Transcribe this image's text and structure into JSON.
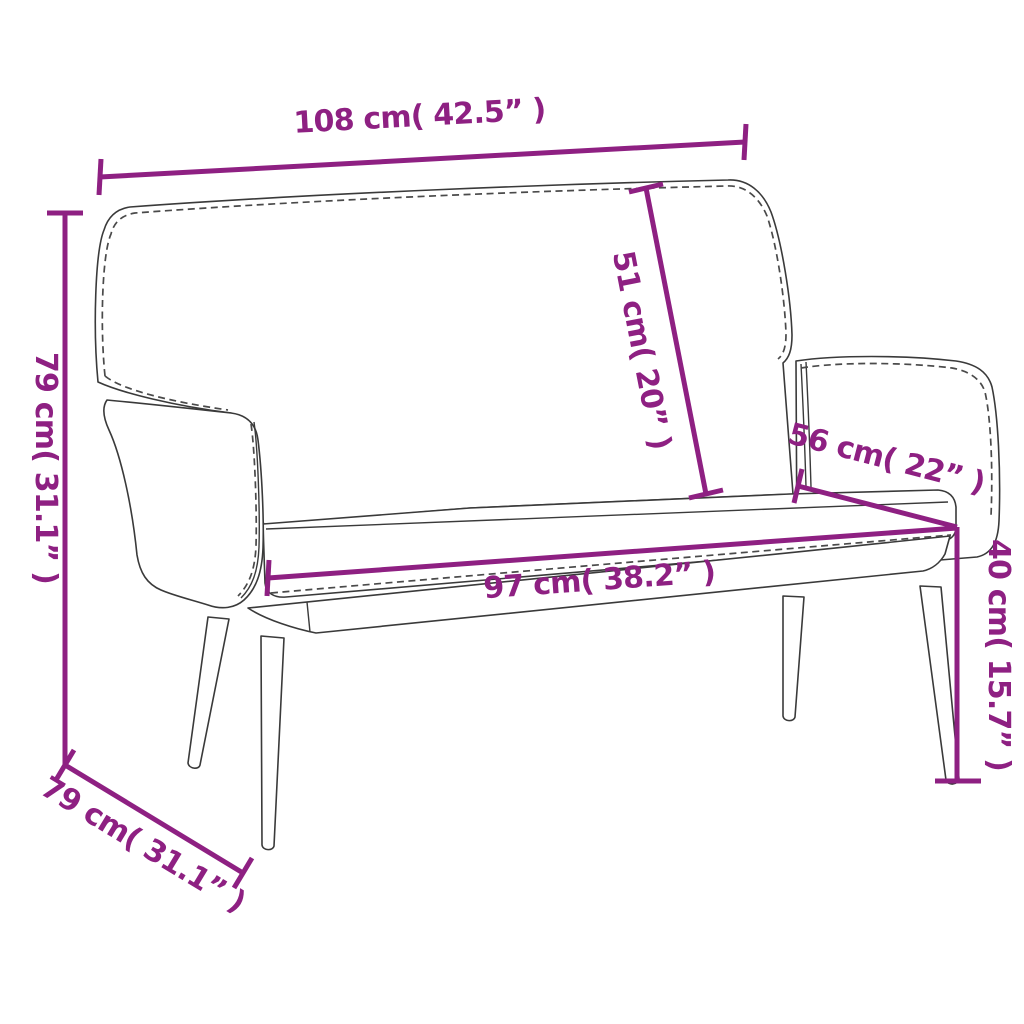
{
  "diagram": {
    "type": "product-dimension-diagram",
    "subject": "upholstered bench with backrest and armrests",
    "accent_color": "#8E2082",
    "outline_color": "#3A3A3A",
    "background_color": "#FFFFFF",
    "dimensions": {
      "overall_width": {
        "label": "108 cm( 42.5” )"
      },
      "overall_height": {
        "label": "79 cm( 31.1” )"
      },
      "backrest_height": {
        "label": "51 cm( 20” )"
      },
      "seat_depth_top": {
        "label": "56 cm( 22” )"
      },
      "seat_width": {
        "label": "97 cm( 38.2” )"
      },
      "seat_height": {
        "label": "40 cm( 15.7” )"
      },
      "overall_depth": {
        "label": "79 cm( 31.1” )"
      }
    }
  }
}
